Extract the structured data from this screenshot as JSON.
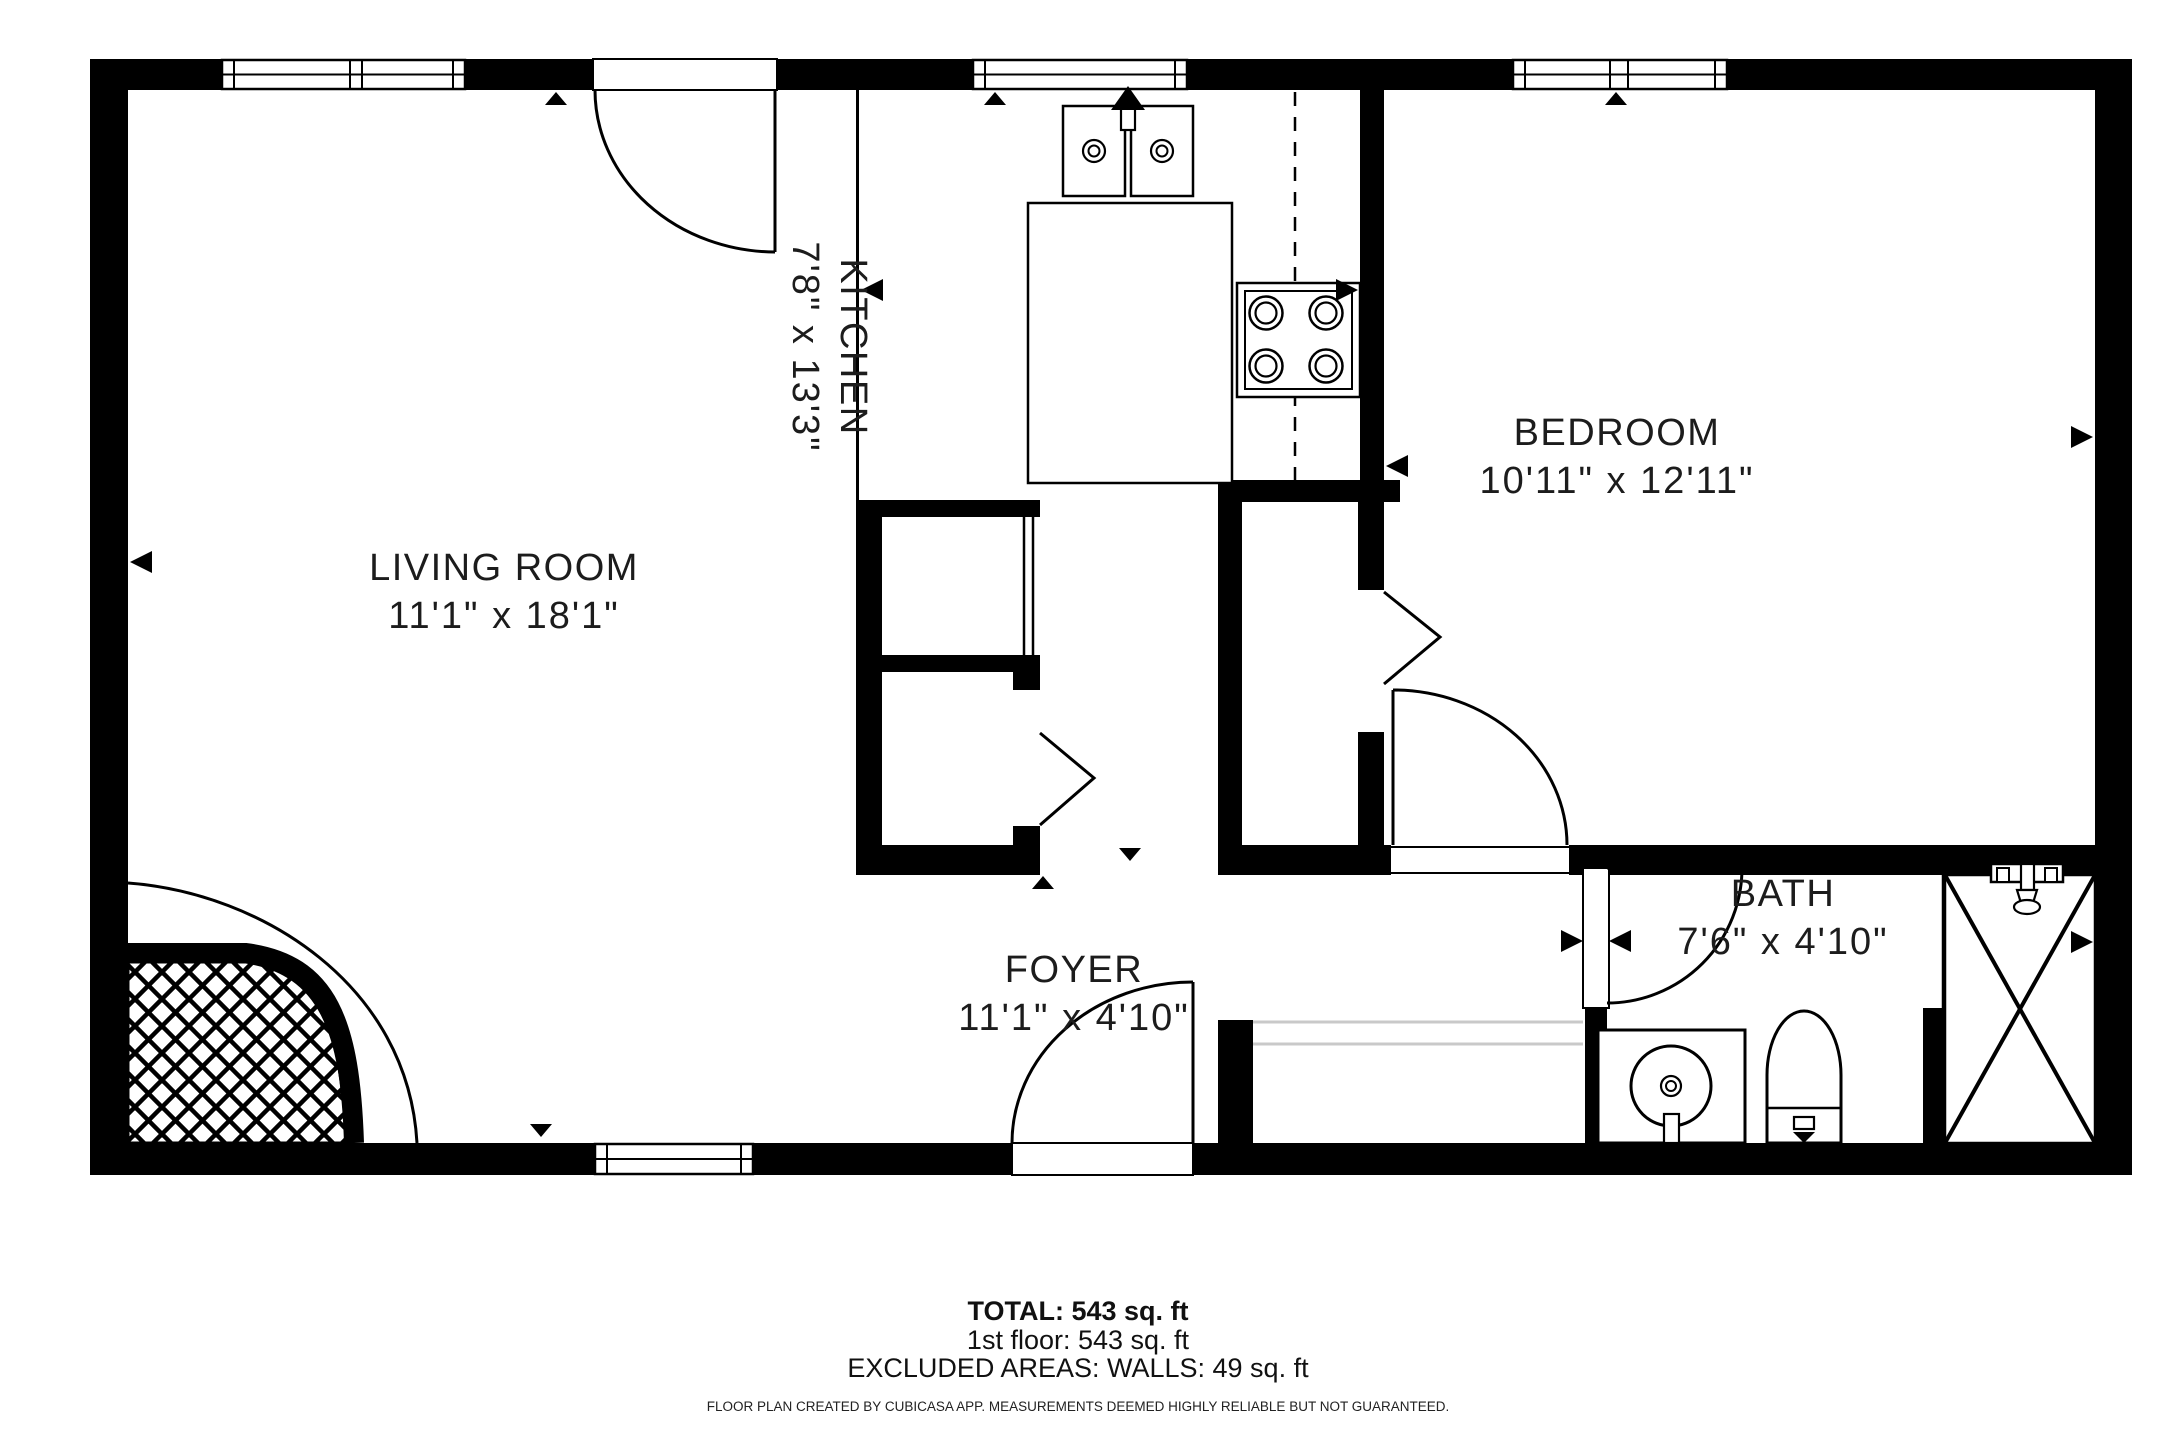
{
  "plan": {
    "rooms": [
      {
        "name": "LIVING ROOM",
        "dimensions": "11'1\" x 18'1\""
      },
      {
        "name": "KITCHEN",
        "dimensions": "7'8\" x 13'3\""
      },
      {
        "name": "BEDROOM",
        "dimensions": "10'11\" x 12'11\""
      },
      {
        "name": "FOYER",
        "dimensions": "11'1\" x 4'10\""
      },
      {
        "name": "BATH",
        "dimensions": "7'6\" x 4'10\""
      }
    ],
    "fixtures": [
      "double-sink",
      "stove-4-burner",
      "kitchen-counter",
      "refrigerator-dashed-outline",
      "fireplace-hearth",
      "vanity-sink",
      "toilet",
      "shower",
      "shower-head",
      "hinged-doors",
      "bifold-closet-doors",
      "windows"
    ],
    "colors": {
      "wall": "#000000",
      "background": "#ffffff",
      "line": "#000000",
      "light_line": "#c9c9c9"
    }
  },
  "summary": {
    "total": "TOTAL: 543 sq. ft",
    "first_floor": "1st floor: 543 sq. ft",
    "excluded_areas": "EXCLUDED AREAS: WALLS: 49 sq. ft",
    "disclaimer": "FLOOR PLAN CREATED BY CUBICASA APP. MEASUREMENTS DEEMED HIGHLY RELIABLE BUT NOT GUARANTEED."
  }
}
